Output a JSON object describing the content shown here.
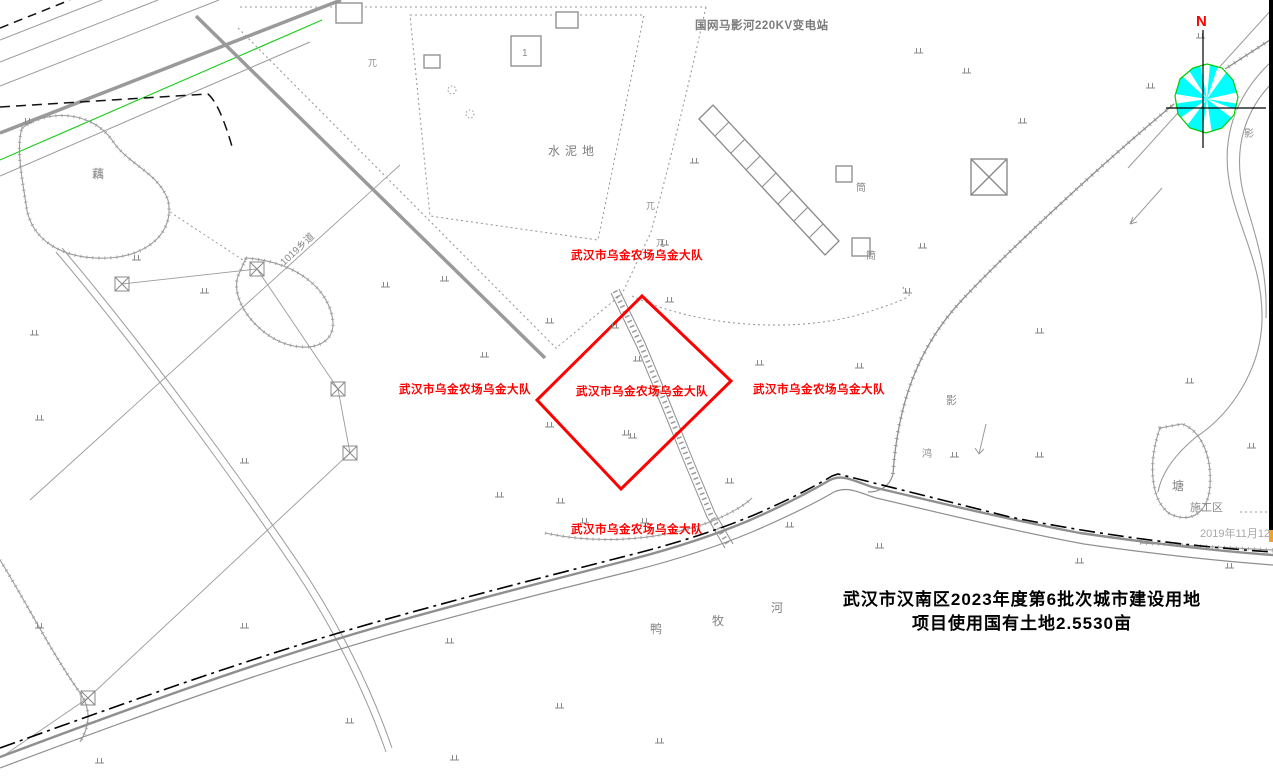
{
  "map": {
    "substation_label": "国网马影河220KV变电站",
    "cement_ground_label": "水泥地",
    "brigade_label": "武汉市乌金农场乌金大队",
    "project_text_line1": "武汉市汉南区2023年度第6批次城市建设用地",
    "project_text_line2": "项目使用国有土地2.5530亩",
    "land_area_mu": "2.5530",
    "north_label": "N",
    "pond_label": "塘",
    "construction_area_label": "施工区",
    "survey_date": "2019年11月12",
    "river_name_chars": {
      "c1": "鸭",
      "c2": "牧",
      "c3": "河"
    },
    "lotus_pond_label": "藕",
    "road_label": "1019乡道",
    "building_number": "1",
    "shed_labels": {
      "s1": "筒",
      "s2": "筒"
    },
    "misc_chars": {
      "m1": "影",
      "m2": "鸿",
      "m3": "影",
      "m4": "兀",
      "m5": "兀",
      "m6": "兀"
    },
    "colors": {
      "parcel_red": "#ff0000",
      "label_red": "#ff0000",
      "compass_cyan": "#00ffff",
      "compass_green": "#00cc00",
      "line_gray": "#8a8a8a",
      "boundary_black": "#000000",
      "green_line": "#22cc22"
    }
  }
}
